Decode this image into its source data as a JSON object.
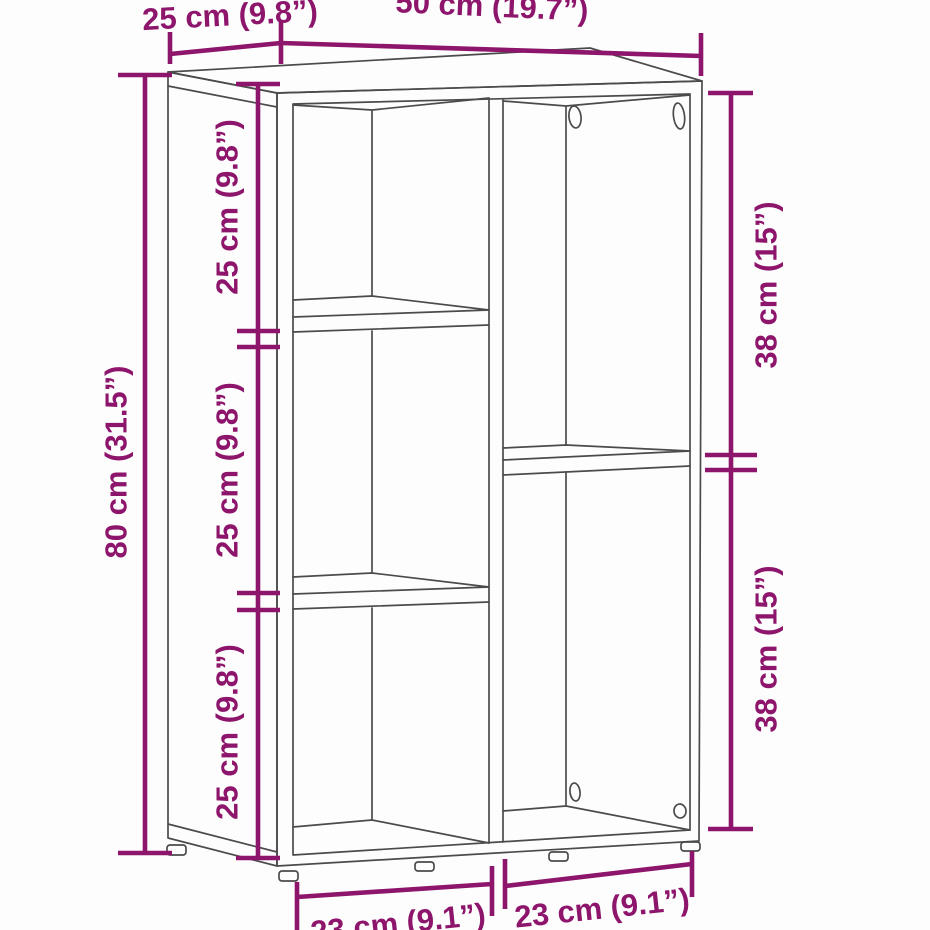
{
  "colors": {
    "line": "#4b4b4b",
    "dimension": "#8d156b",
    "background": "#fdfdfd"
  },
  "diagram": {
    "type": "furniture-dimension-diagram",
    "subject": "5-compartment book cabinet line drawing",
    "labels": {
      "depth_top": "25 cm (9.8”)",
      "width_top": "50 cm (19.7”)",
      "height_left": "80 cm (31.5”)",
      "left_cell_1": "25 cm (9.8”)",
      "left_cell_2": "25 cm (9.8”)",
      "left_cell_3": "25 cm (9.8”)",
      "right_cell_1": "38 cm (15”)",
      "right_cell_2": "38 cm (15”)",
      "bottom_left": "23 cm (9.1”)",
      "bottom_right": "23 cm (9.1”)"
    }
  }
}
